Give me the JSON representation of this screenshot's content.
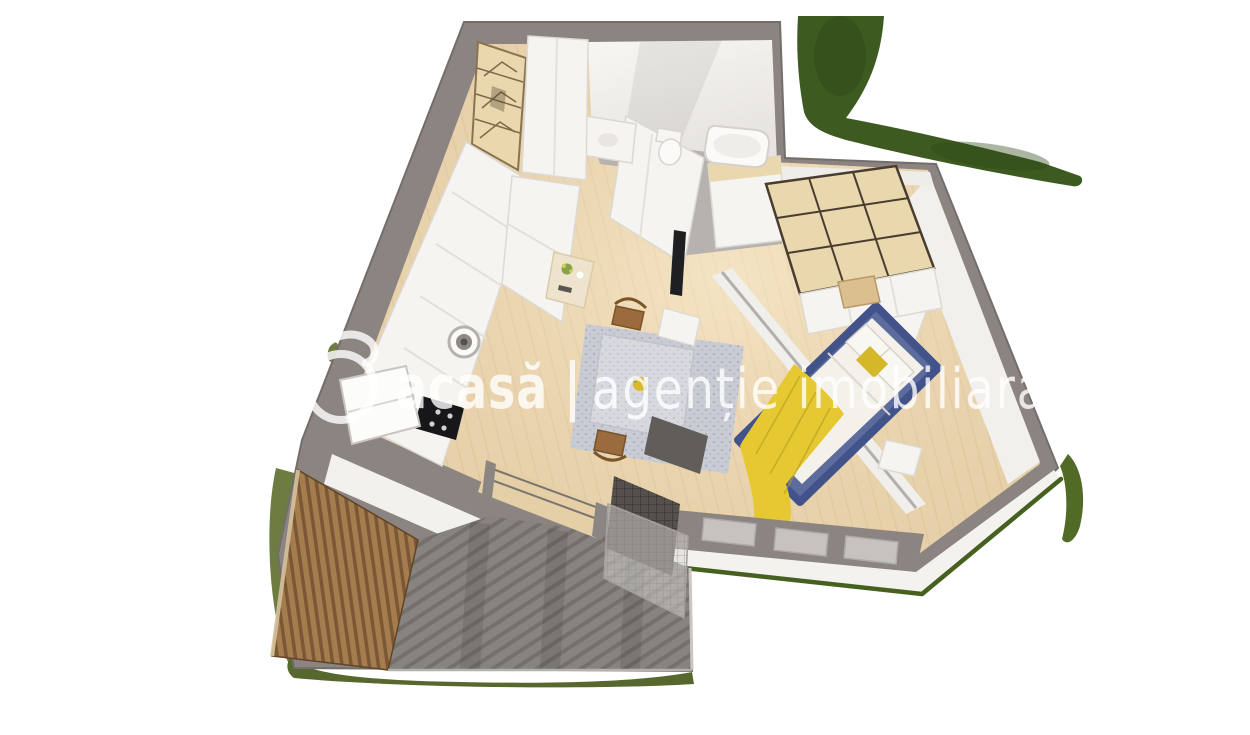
{
  "watermark": {
    "logo": "acasa-circle-swirl-logo",
    "brand": "acasă",
    "separator": "|",
    "tagline": "agenție imobiliara",
    "color": "#ffffff",
    "opacity": 0.8
  },
  "colors": {
    "background": "#ffffff",
    "wall": "#8b8481",
    "wall_dark": "#746e6a",
    "floor_wood": "#e8d2ac",
    "floor_wood_light": "#f3e2c2",
    "tile": "#b6b2ae",
    "grass_dark": "#3d5a20",
    "grass_moss": "#6d7c40",
    "grass_edge": "#46611f",
    "deck": "#87837e",
    "deck_stripe": "#6d6965",
    "wood_slats": "#a57c4e",
    "wood_slats_dark": "#7a5836",
    "furniture_white": "#f6f4f1",
    "wardrobe_wood": "#e9d7ae",
    "bed_blue": "#5c6c9c",
    "bed_blue_dark": "#41538a",
    "blanket_yellow": "#e6c832",
    "pillow_white": "#f4f1ea",
    "rug": "#c9ccd4",
    "cooktop_black": "#17171a"
  },
  "scene": {
    "type": "3d-floorplan-render",
    "description": "Isometric 3D rendering of a one-bedroom apartment with terrace, viewed from above",
    "rooms": [
      "bathroom",
      "hallway",
      "kitchen",
      "living-dining",
      "bedroom",
      "terrace"
    ]
  }
}
